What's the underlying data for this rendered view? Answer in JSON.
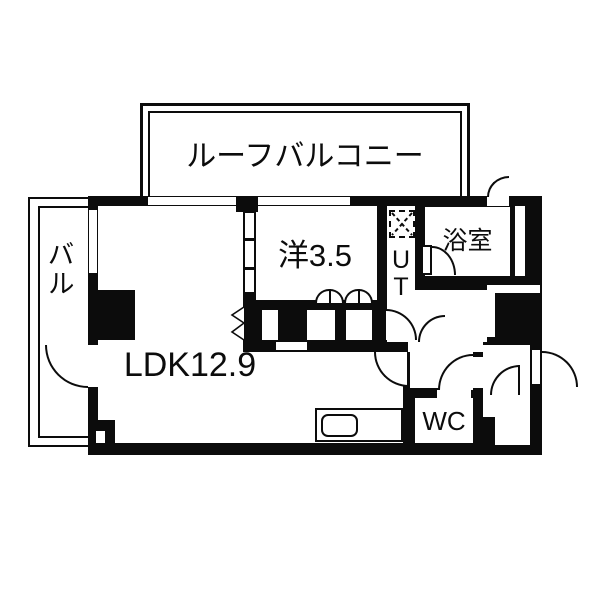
{
  "title": "apartment-floor-plan",
  "colors": {
    "wall": "#0c0c0c",
    "background": "#ffffff",
    "line": "#0c0c0c"
  },
  "rooms": {
    "roof_balcony": {
      "label": "ルーフバルコニー"
    },
    "balcony": {
      "label": "バル"
    },
    "ldk": {
      "label": "LDK12.9"
    },
    "western": {
      "label": "洋3.5"
    },
    "bath": {
      "label": "浴室"
    },
    "utility": {
      "label": "UT",
      "letters": [
        "U",
        "T"
      ]
    },
    "wc": {
      "label": "WC"
    }
  }
}
